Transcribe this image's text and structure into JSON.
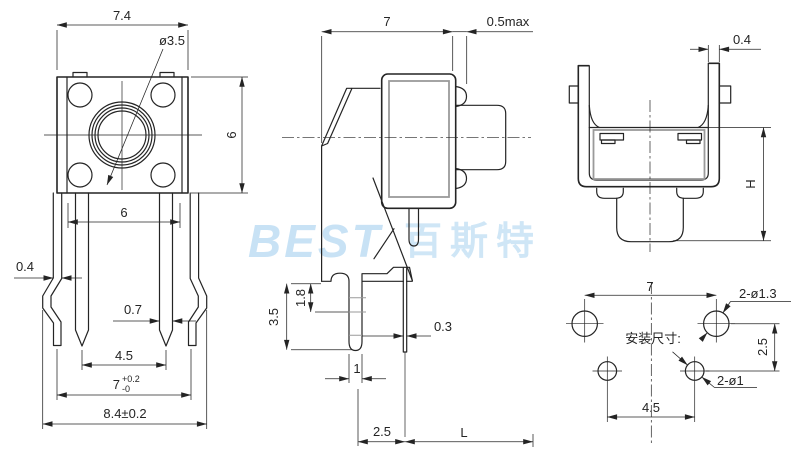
{
  "watermark": {
    "latin": "BEST",
    "cjk": "百斯特"
  },
  "colors": {
    "line": "#242424",
    "secondary_gray": "#9a9a9a",
    "watermark_blue": "#c8e2f5",
    "background": "#ffffff"
  },
  "front_view": {
    "dims": {
      "body_width": "7.4",
      "actuator_dia": "ø3.5",
      "body_height": "6",
      "pin_row_span": "6",
      "bracket_leg_thickness": "0.4",
      "pin_width": "0.7",
      "pin_pitch": "4.5",
      "bracket_pitch_base": "7",
      "bracket_pitch_plus": "+0.2",
      "bracket_pitch_minus": "-0",
      "overall_width": "8.4±0.2"
    }
  },
  "side_view": {
    "dims": {
      "body_depth": "7",
      "clearance": "0.5max",
      "foot_height": "3.5",
      "slot_height": "1.8",
      "pin_thickness": "0.3",
      "peg_width": "1",
      "peg_to_pin": "2.5",
      "pin_length": "L"
    }
  },
  "end_view": {
    "dims": {
      "bracket_thickness": "0.4",
      "mount_height": "H"
    }
  },
  "mounting_layout": {
    "caption": "安装尺寸:",
    "dims": {
      "hole_pitch_x": "7",
      "upper_holes": "2-ø1.3",
      "row_pitch": "2.5",
      "lower_holes": "2-ø1",
      "lower_pitch_x": "4.5"
    }
  }
}
